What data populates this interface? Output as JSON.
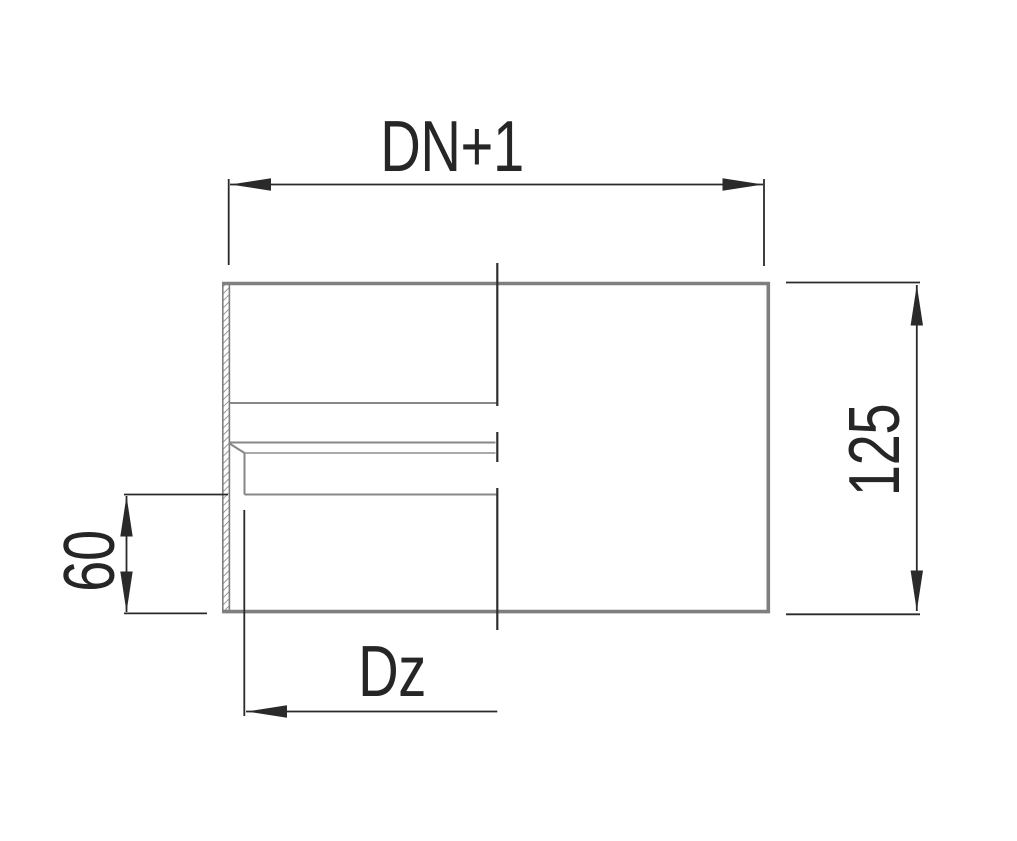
{
  "drawing": {
    "title": "technical dimension drawing of a pipe sleeve cross-section",
    "labels": {
      "top": "DN+1",
      "right": "125",
      "left": "60",
      "bottom": "Dz"
    },
    "dimensions": [
      {
        "id": "top",
        "label": "DN+1",
        "orientation": "horizontal",
        "arrows": "both-outward"
      },
      {
        "id": "right",
        "label": "125",
        "orientation": "vertical",
        "arrows": "both-outward"
      },
      {
        "id": "left",
        "label": "60",
        "orientation": "vertical",
        "arrows": "both-outward"
      },
      {
        "id": "bottom",
        "label": "Dz",
        "orientation": "horizontal",
        "arrows": "left-only"
      }
    ],
    "colors": {
      "background": "#ffffff",
      "outline": "#7f7f7f",
      "inner_line": "#878787",
      "inner_line_light": "#9e9e9e",
      "dimension": "#2a2a2a",
      "center_line": "#2e2e2e",
      "text": "#262626"
    }
  }
}
